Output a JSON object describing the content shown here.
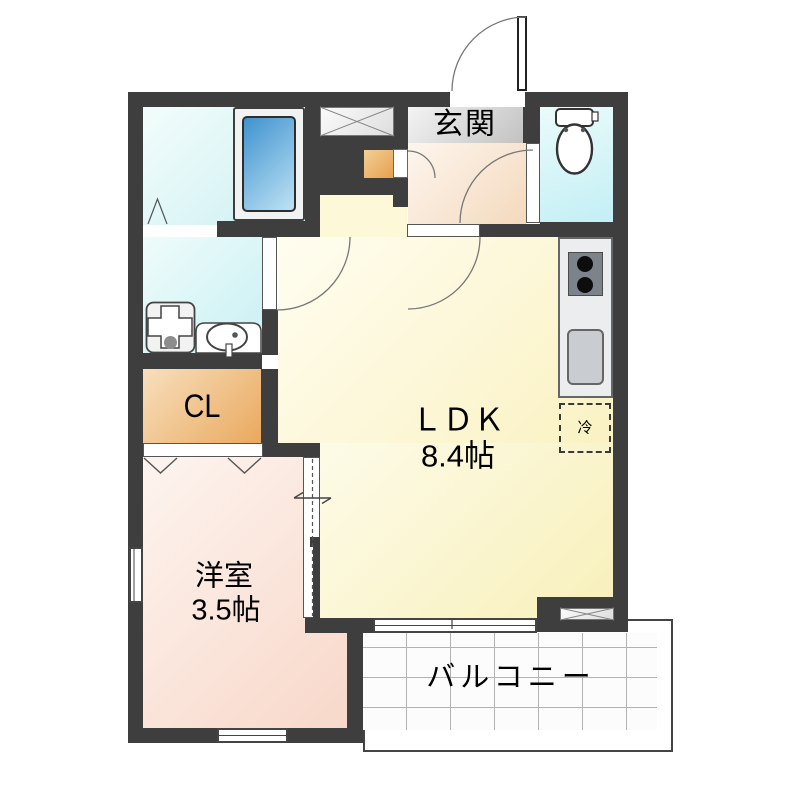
{
  "plan_title": "1K apartment floor plan",
  "rooms": {
    "entrance": {
      "label": "玄関"
    },
    "ldk": {
      "label": "ＬＤＫ",
      "size": "8.4帖"
    },
    "western_room": {
      "label": "洋室",
      "size": "3.5帖"
    },
    "closet": {
      "label": "CL"
    },
    "balcony": {
      "label": "バルコニー"
    }
  },
  "fixtures": {
    "refrigerator": {
      "label": "冷",
      "name": "refrigerator-space"
    },
    "bathtub": {
      "name": "bathtub"
    },
    "toilet": {
      "name": "toilet"
    },
    "washing_machine_pan": {
      "name": "washing-machine-pan"
    },
    "washbasin": {
      "name": "washbasin"
    },
    "stove": {
      "name": "gas-stove-2-burner"
    },
    "kitchen_sink": {
      "name": "kitchen-sink"
    }
  },
  "colors": {
    "wall": "#3e3e3e",
    "water_rooms": "#d2f1f5",
    "ldk": "#f9f1c0",
    "western_room": "#f8d8c9",
    "entrance": "#f4d9bd",
    "closet": "#e9a95e",
    "bathtub": "#4a9ad4",
    "balcony_tile_line": "#b3b3b3"
  }
}
